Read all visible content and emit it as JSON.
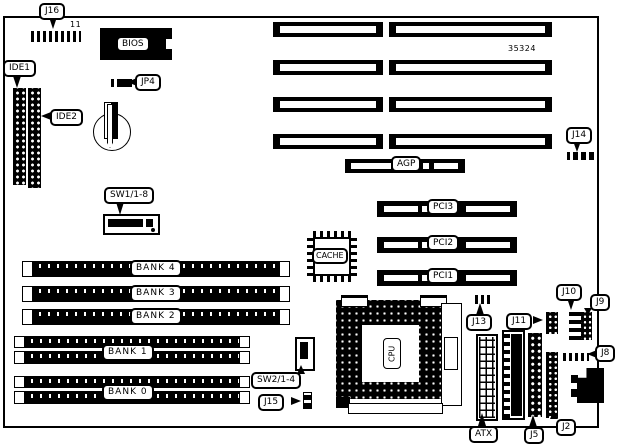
{
  "diagram_title": "motherboard-layout",
  "board": {
    "part_number": "35324"
  },
  "colors": {
    "ink": "#000000",
    "paper": "#ffffff"
  },
  "labels": {
    "j16": "J16",
    "pin11": "11",
    "bios": "BIOS",
    "ide1": "IDE1",
    "ide2": "IDE2",
    "jp4": "JP4",
    "j14": "J14",
    "agp": "AGP",
    "sw1": "SW1/1-8",
    "cache": "CACHE",
    "pci3": "PCI3",
    "pci2": "PCI2",
    "pci1": "PCI1",
    "bank4": "BANK 4",
    "bank3": "BANK 3",
    "bank2": "BANK 2",
    "bank1": "BANK 1",
    "bank0": "BANK 0",
    "sw2": "SW2/1-4",
    "j15": "J15",
    "cpu": "CPU",
    "j13": "J13",
    "j11": "J11",
    "j10": "J10",
    "j9": "J9",
    "j8": "J8",
    "atx": "ATX",
    "j5": "J5",
    "j2": "J2"
  }
}
